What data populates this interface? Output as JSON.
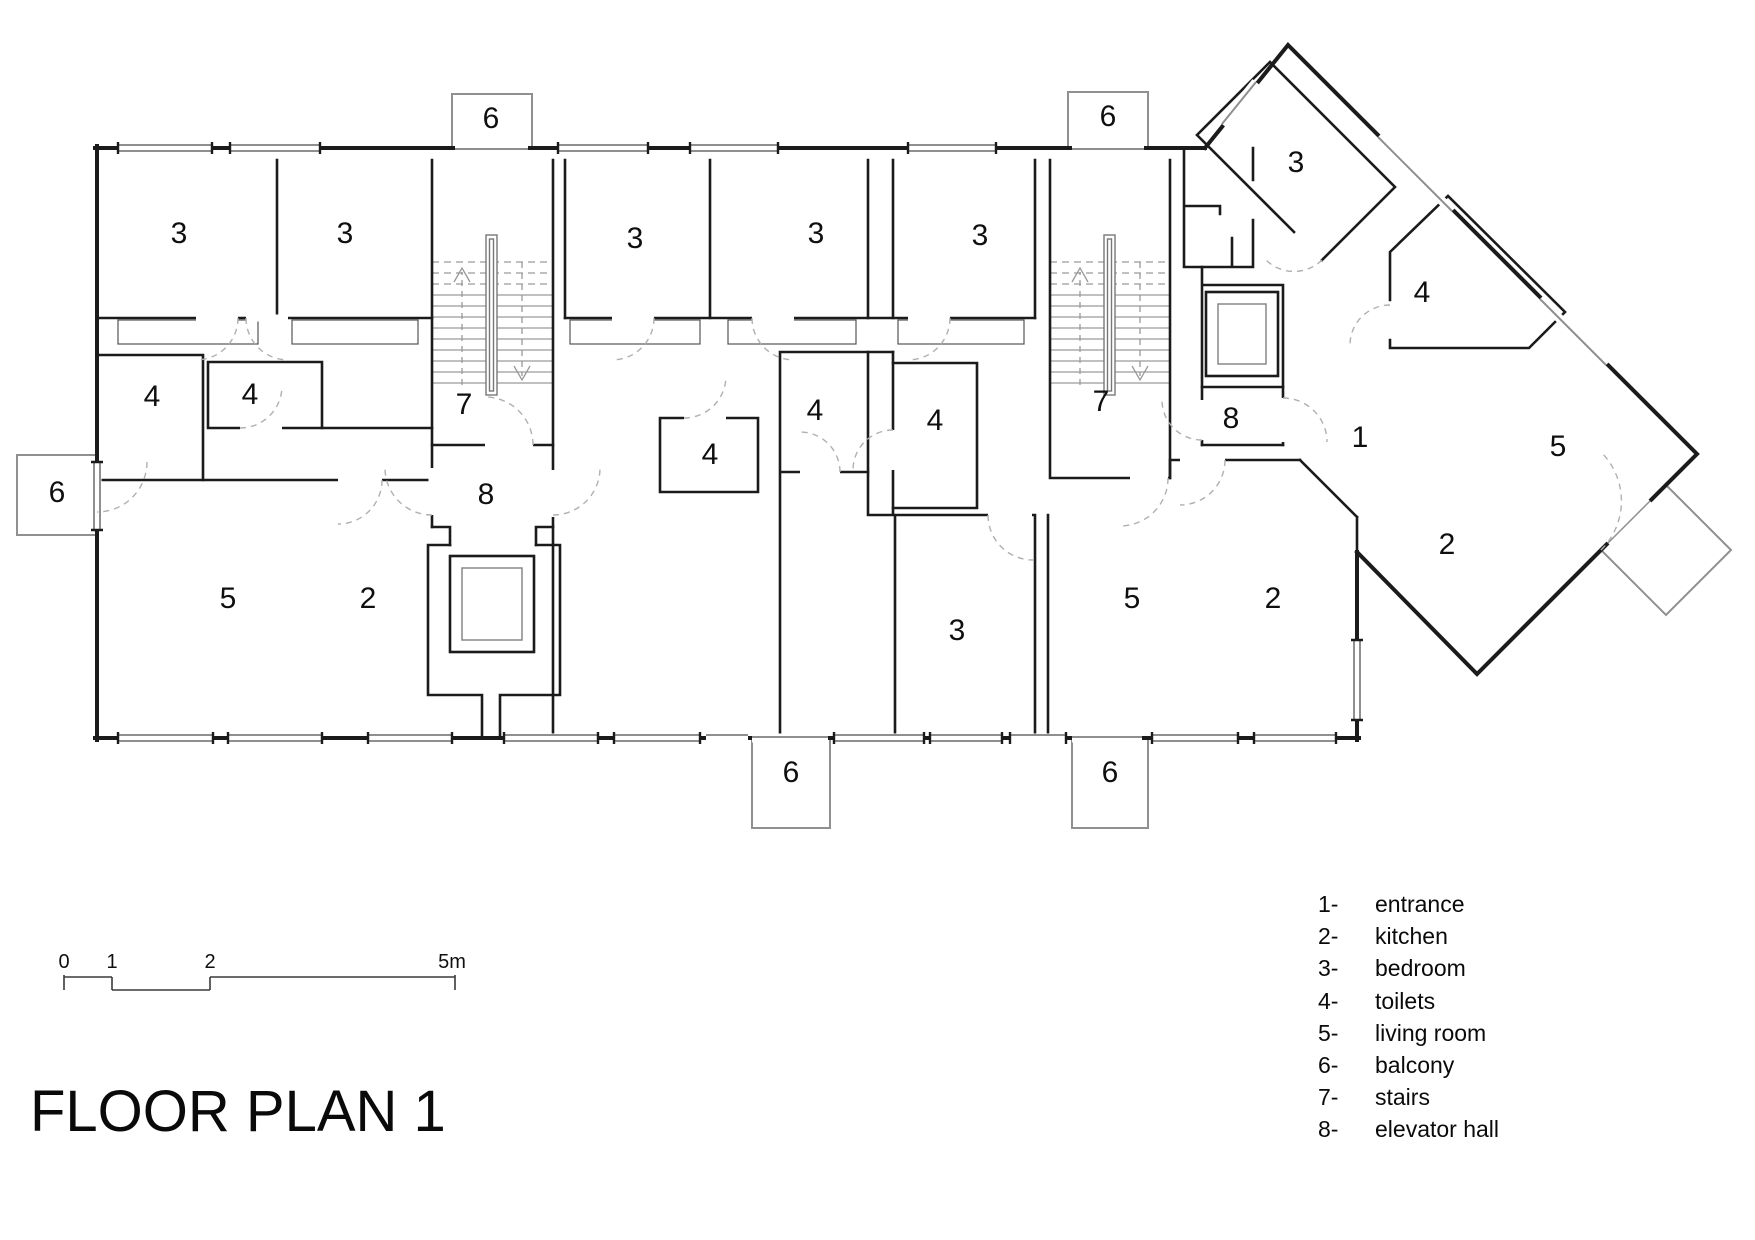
{
  "title": "FLOOR PLAN 1",
  "legend": {
    "items": [
      {
        "num": "1-",
        "label": "entrance"
      },
      {
        "num": "2-",
        "label": "kitchen"
      },
      {
        "num": "3-",
        "label": "bedroom"
      },
      {
        "num": "4-",
        "label": "toilets"
      },
      {
        "num": "5-",
        "label": "living room"
      },
      {
        "num": "6-",
        "label": "balcony"
      },
      {
        "num": "7-",
        "label": "stairs"
      },
      {
        "num": "8-",
        "label": "elevator hall"
      }
    ]
  },
  "scale_bar": {
    "ticks": [
      {
        "t": "0",
        "x": 64
      },
      {
        "t": "1",
        "x": 112
      },
      {
        "t": "2",
        "x": 210
      },
      {
        "t": "5m",
        "x": 452
      }
    ]
  },
  "plan": {
    "room_labels": [
      {
        "t": "3",
        "x": 179,
        "y": 243
      },
      {
        "t": "3",
        "x": 345,
        "y": 243
      },
      {
        "t": "3",
        "x": 635,
        "y": 248
      },
      {
        "t": "3",
        "x": 816,
        "y": 243
      },
      {
        "t": "3",
        "x": 980,
        "y": 245
      },
      {
        "t": "3",
        "x": 957,
        "y": 640
      },
      {
        "t": "3",
        "x": 1296,
        "y": 172
      },
      {
        "t": "4",
        "x": 152,
        "y": 406
      },
      {
        "t": "4",
        "x": 250,
        "y": 404
      },
      {
        "t": "4",
        "x": 710,
        "y": 464
      },
      {
        "t": "4",
        "x": 815,
        "y": 420
      },
      {
        "t": "4",
        "x": 935,
        "y": 430
      },
      {
        "t": "4",
        "x": 1422,
        "y": 302
      },
      {
        "t": "5",
        "x": 228,
        "y": 608
      },
      {
        "t": "5",
        "x": 1132,
        "y": 608
      },
      {
        "t": "5",
        "x": 1558,
        "y": 456
      },
      {
        "t": "2",
        "x": 368,
        "y": 608
      },
      {
        "t": "2",
        "x": 1273,
        "y": 608
      },
      {
        "t": "2",
        "x": 1447,
        "y": 554
      },
      {
        "t": "1",
        "x": 1360,
        "y": 447
      },
      {
        "t": "6",
        "x": 491,
        "y": 128
      },
      {
        "t": "6",
        "x": 1108,
        "y": 126
      },
      {
        "t": "6",
        "x": 57,
        "y": 502
      },
      {
        "t": "6",
        "x": 791,
        "y": 782
      },
      {
        "t": "6",
        "x": 1110,
        "y": 782
      },
      {
        "t": "7",
        "x": 464,
        "y": 414
      },
      {
        "t": "7",
        "x": 1101,
        "y": 411
      },
      {
        "t": "8",
        "x": 486,
        "y": 504
      },
      {
        "t": "8",
        "x": 1231,
        "y": 428
      }
    ]
  }
}
